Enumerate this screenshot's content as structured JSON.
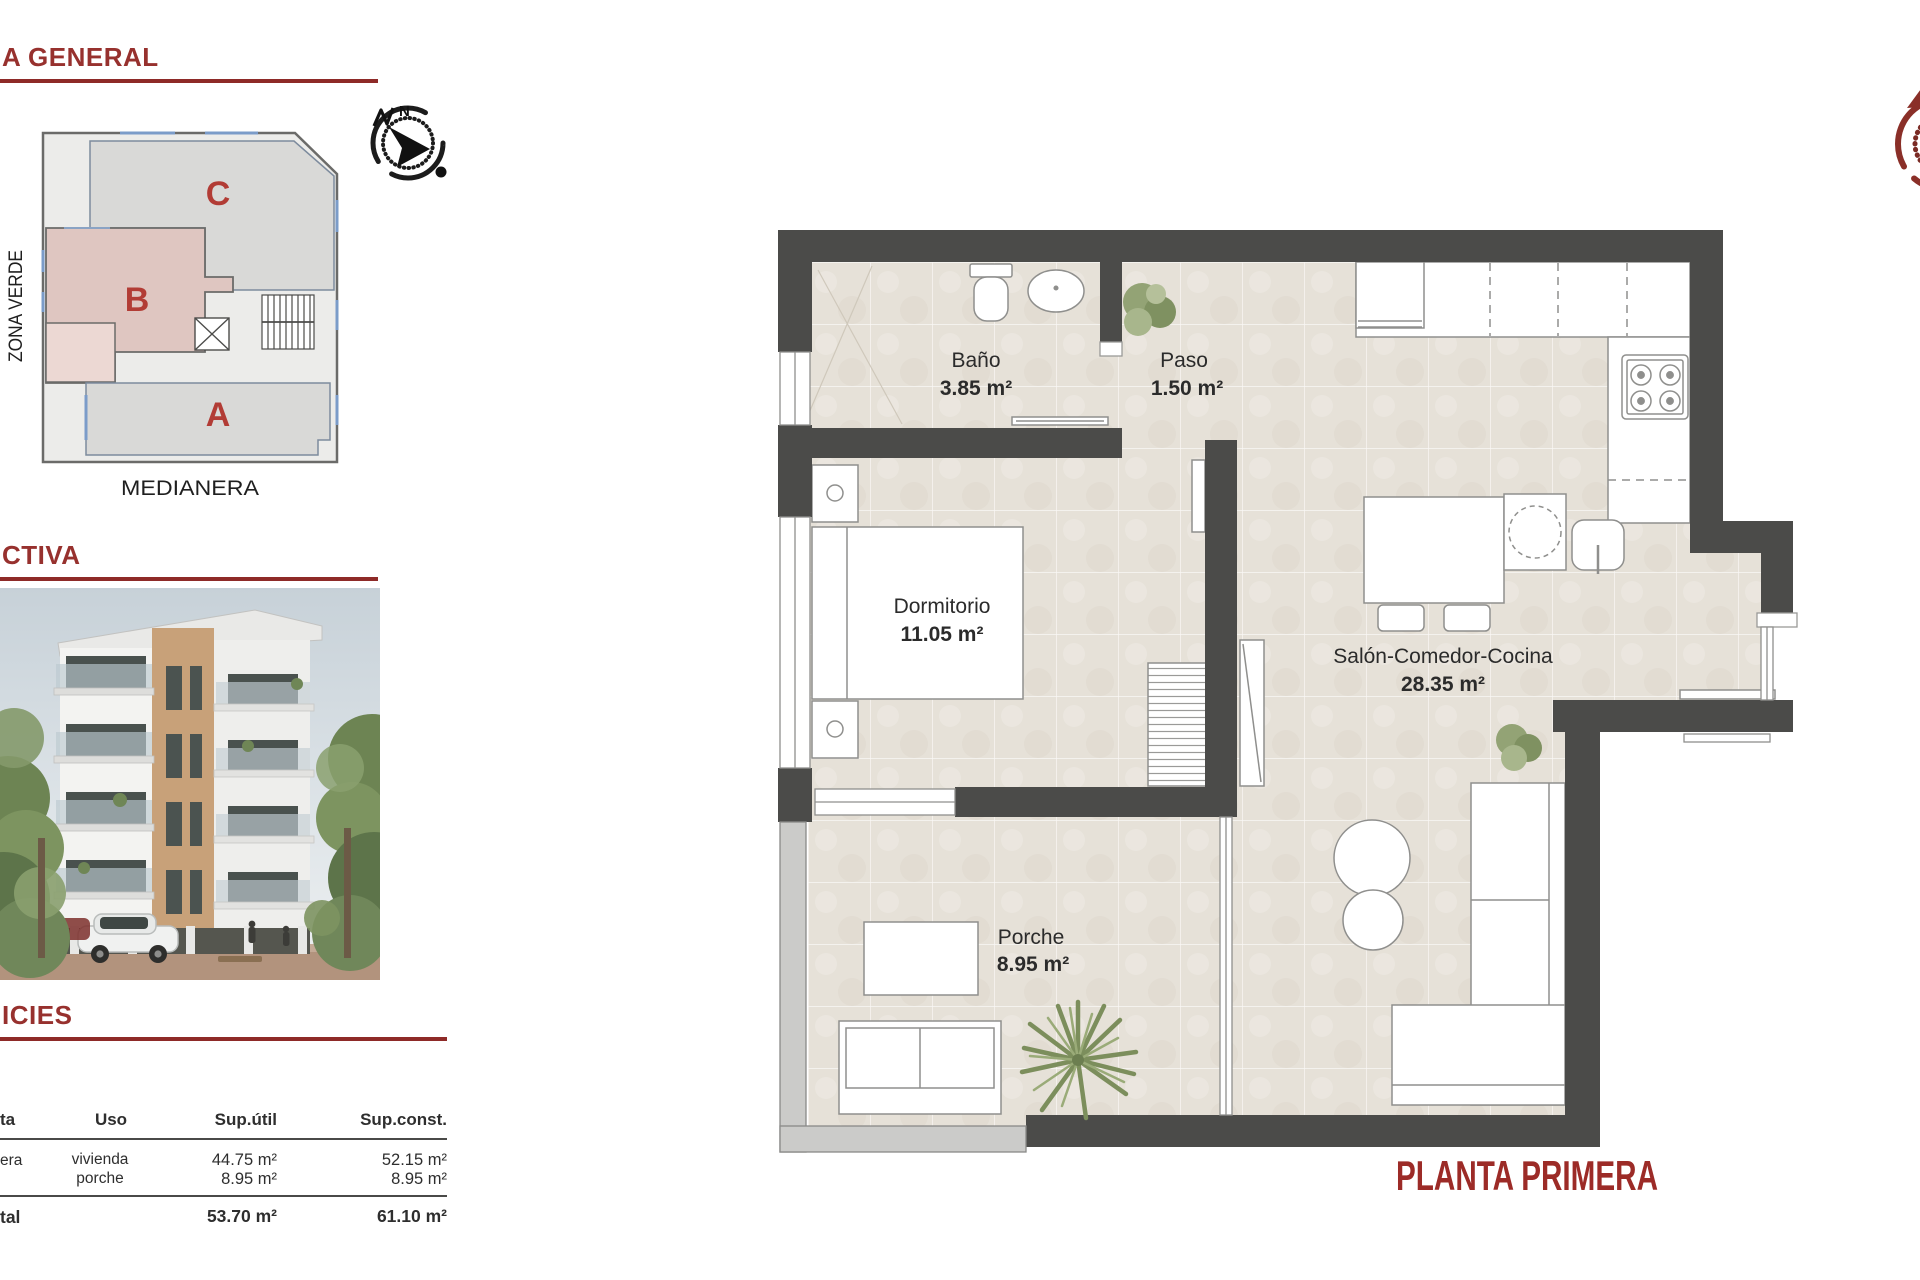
{
  "left_panel": {
    "general_section": {
      "header": "A GENERAL"
    },
    "site_plan": {
      "block_c": "C",
      "block_b": "B",
      "block_a": "A",
      "zona_verde": "ZONA VERDE",
      "medianera": "MEDIANERA",
      "north_letter": "N"
    },
    "perspective_section": {
      "header": "CTIVA"
    },
    "surfaces_section": {
      "header": "ICIES"
    },
    "table": {
      "headers": {
        "planta": "ta",
        "uso": "Uso",
        "sup_util": "Sup.útil",
        "sup_const": "Sup.const."
      },
      "row": {
        "planta": "era",
        "uso_line1": "vivienda",
        "uso_line2": "porche",
        "util_line1": "44.75 m²",
        "util_line2": "8.95 m²",
        "const_line1": "52.15 m²",
        "const_line2": "8.95 m²"
      },
      "total": {
        "planta": "tal",
        "util": "53.70 m²",
        "const": "61.10 m²"
      }
    }
  },
  "floor_plan": {
    "title": "PLANTA PRIMERA",
    "north_letter": "N",
    "rooms": {
      "bano": {
        "name": "Baño",
        "area": "3.85 m²"
      },
      "paso": {
        "name": "Paso",
        "area": "1.50 m²"
      },
      "dormitorio": {
        "name": "Dormitorio",
        "area": "11.05 m²"
      },
      "salon": {
        "name": "Salón-Comedor-Cocina",
        "area": "28.35 m²"
      },
      "porche": {
        "name": "Porche",
        "area": "8.95 m²"
      }
    }
  },
  "colors": {
    "heading_red": "#97312e",
    "underline_red": "#8e2a28",
    "accent_red": "#b23c35",
    "title_red": "#9c2b27",
    "wall_dark": "#4b4b49",
    "floor_beige": "#e6e1d8",
    "site_gray": "#d9d9d7",
    "site_pink": "#dfc6c1",
    "site_pink_light": "#ecd8d3"
  }
}
